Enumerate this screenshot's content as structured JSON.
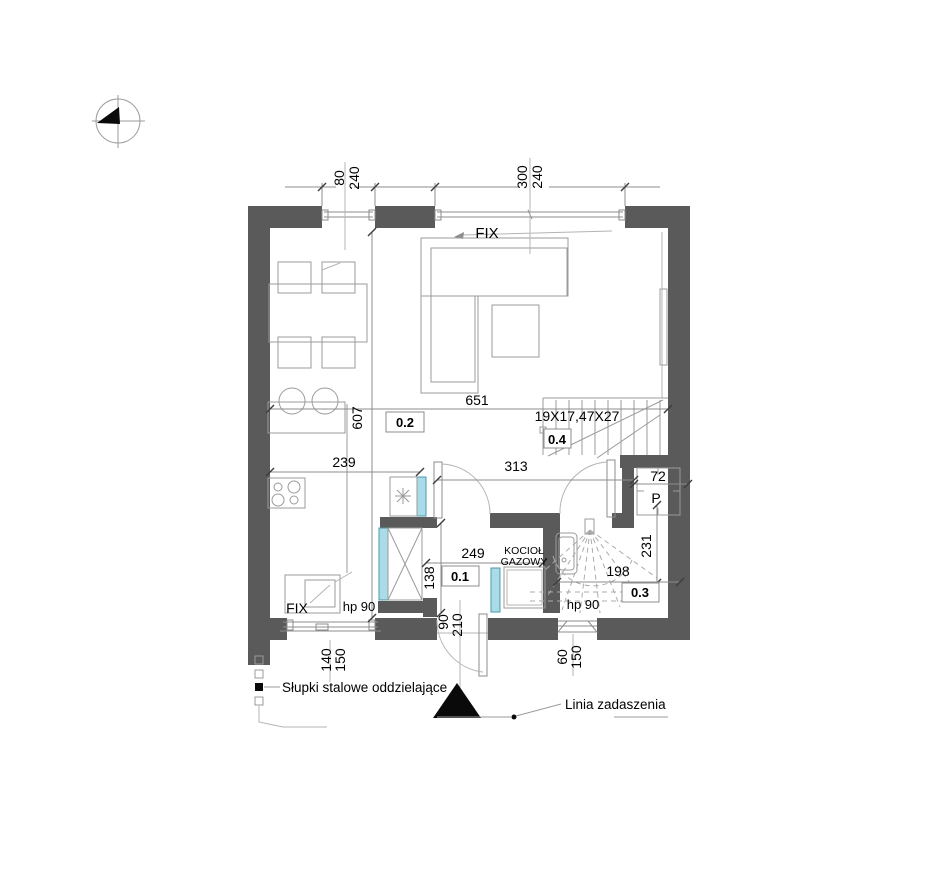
{
  "colors": {
    "wall": "#5a5a5a",
    "door_leaf": "#a9dce8",
    "line": "#9b9b9b",
    "text": "#000000"
  },
  "icons": {
    "north_arrow": "north-compass-icon",
    "entrance_marker": "entrance-triangle-icon"
  },
  "windows": {
    "top_left": {
      "w": "80",
      "h": "240"
    },
    "top_right": {
      "w": "300",
      "h": "240",
      "label": "FIX"
    },
    "bottom_left": {
      "w": "140",
      "h": "150",
      "label": "FIX",
      "sill": "hp 90"
    },
    "bottom_right": {
      "w": "60",
      "h": "150",
      "sill": "hp 90"
    }
  },
  "doors": {
    "entrance": {
      "w": "90",
      "h": "210"
    }
  },
  "rooms": {
    "living": "0.2",
    "hall": "0.1",
    "bath": "0.3",
    "stairs": "0.4"
  },
  "dims": {
    "room_w": "651",
    "room_h": "607",
    "kitchen": "239",
    "hall_w": "313",
    "vest_w": "249",
    "vest_h": "138",
    "niche": "72",
    "bath_h": "231",
    "bath_w": "198"
  },
  "stairs": {
    "spec": "19X17,47X27"
  },
  "equipment": {
    "boiler_1": "KOCIOŁ",
    "boiler_2": "GAZOWY",
    "washer": "P"
  },
  "annotations": {
    "steel_posts": "Słupki stalowe oddzielające",
    "canopy_line": "Linia zadaszenia"
  }
}
